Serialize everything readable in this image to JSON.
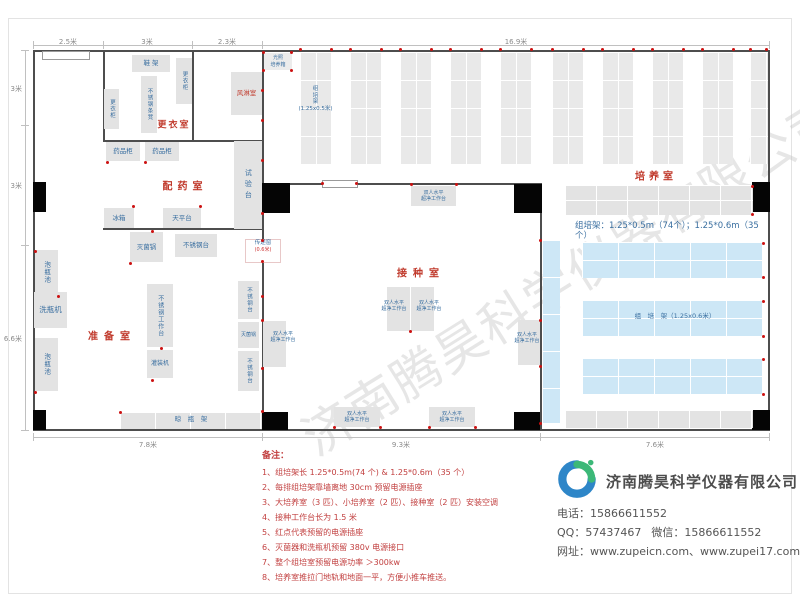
{
  "dims": {
    "top": [
      "2.5米",
      "3米",
      "2.3米",
      "16.9米"
    ],
    "left": [
      "3米",
      "3米",
      "6.6米"
    ],
    "bottom": [
      "7.8米",
      "9.3米",
      "7.6米"
    ]
  },
  "rooms": {
    "changing": "更衣室",
    "air_shower": "风淋室",
    "dispensing": "配药室",
    "prep": "准备室",
    "inoculation": "接种室",
    "culture": "培养室"
  },
  "equipment": {
    "shoe_rack": "鞋 架",
    "locker": "更衣柜",
    "steel_stool": "不锈钢条凳",
    "light_incubator": "光照\n培养箱",
    "medicine_cabinet": "药品柜",
    "fridge": "冰箱",
    "balance_table": "天平台",
    "test_bench": "试验台",
    "soak_pool": "泡瓶池",
    "bottle_washer": "洗瓶机",
    "sterilizer": "灭菌锅",
    "steel_table": "不锈钢台",
    "steel_worktable": "不锈钢工作台",
    "filling_machine": "灌装机",
    "drying_rack": "晾　瓶　架",
    "pass_window": "传递窗",
    "pass_window_size": "(0.6米)",
    "clean_bench": "双人水平\n超净工作台",
    "vrack_label": "组\n培\n架\n(1.25x0.5米)",
    "rack_spec": "组培架：1.25*0.5m（74个）；1.25*0.6m（35个）",
    "hrack_label": "组　培　架（1.25x0.6米）"
  },
  "notes": {
    "title": "备注：",
    "items": [
      "1、组培架长 1.25*0.5m(74 个) & 1.25*0.6m（35 个）",
      "2、每排组培架靠墙离地 30cm 预留电源插座",
      "3、大培养室（3 匹）、小培养室（2 匹）、接种室（2 匹）安装空调",
      "4、接种工作台长为 1.5 米",
      "5、红点代表预留的电源插座",
      "6、灭菌器和洗瓶机预留 380v 电源接口",
      "7、整个组培室预留电源功率 ＞300kw",
      "8、培养室推拉门地轨和地面一平，方便小推车推送。"
    ]
  },
  "contact": {
    "company": "济南腾昊科学仪器有限公司",
    "logo_text": "TH",
    "phone_label": "电话：",
    "phone": "15866611552",
    "qq_label": "QQ：",
    "qq": "57437467",
    "wechat_label": "微信：",
    "wechat": "15866611552",
    "web_label": "网址：",
    "web": "www.zupeicn.com、www.zupei17.com"
  },
  "watermark": "济南腾昊科学仪器有限公司",
  "colors": {
    "room_label": "#c0392b",
    "equipment_text": "#3a6fa0",
    "rack_blue": "#cde7f6",
    "outlet_red": "#cc1111",
    "wall": "#4d4d4d"
  },
  "plan": {
    "vrack_y": 52,
    "vrack_h": 112,
    "vrack_w": 31,
    "vrack_xs": [
      300,
      350,
      400,
      450,
      500,
      552,
      602,
      652,
      702,
      750
    ],
    "outlets": [
      [
        300,
        49
      ],
      [
        331,
        49
      ],
      [
        350,
        49
      ],
      [
        381,
        49
      ],
      [
        400,
        49
      ],
      [
        431,
        49
      ],
      [
        450,
        49
      ],
      [
        481,
        49
      ],
      [
        500,
        49
      ],
      [
        531,
        49
      ],
      [
        552,
        49
      ],
      [
        583,
        49
      ],
      [
        602,
        49
      ],
      [
        633,
        49
      ],
      [
        652,
        49
      ],
      [
        683,
        49
      ],
      [
        702,
        49
      ],
      [
        733,
        49
      ],
      [
        750,
        49
      ],
      [
        766,
        49
      ],
      [
        263,
        52
      ],
      [
        291,
        52
      ],
      [
        263,
        70
      ],
      [
        291,
        70
      ],
      [
        262,
        90
      ],
      [
        262,
        120
      ],
      [
        262,
        160
      ],
      [
        262,
        213
      ],
      [
        262,
        240
      ],
      [
        262,
        261
      ],
      [
        262,
        296
      ],
      [
        262,
        320
      ],
      [
        262,
        368
      ],
      [
        262,
        411
      ],
      [
        107,
        162
      ],
      [
        145,
        162
      ],
      [
        133,
        206
      ],
      [
        200,
        206
      ],
      [
        152,
        231
      ],
      [
        130,
        263
      ],
      [
        161,
        348
      ],
      [
        152,
        380
      ],
      [
        58,
        296
      ],
      [
        35,
        251
      ],
      [
        35,
        392
      ],
      [
        120,
        412
      ],
      [
        322,
        183
      ],
      [
        356,
        183
      ],
      [
        411,
        184
      ],
      [
        456,
        184
      ],
      [
        410,
        331
      ],
      [
        540,
        240
      ],
      [
        540,
        320
      ],
      [
        540,
        366
      ],
      [
        540,
        423
      ],
      [
        334,
        427
      ],
      [
        380,
        427
      ],
      [
        429,
        427
      ],
      [
        475,
        427
      ],
      [
        763,
        243
      ],
      [
        763,
        277
      ],
      [
        763,
        301
      ],
      [
        763,
        336
      ],
      [
        763,
        359
      ],
      [
        763,
        394
      ],
      [
        752,
        186
      ],
      [
        752,
        214
      ]
    ]
  }
}
